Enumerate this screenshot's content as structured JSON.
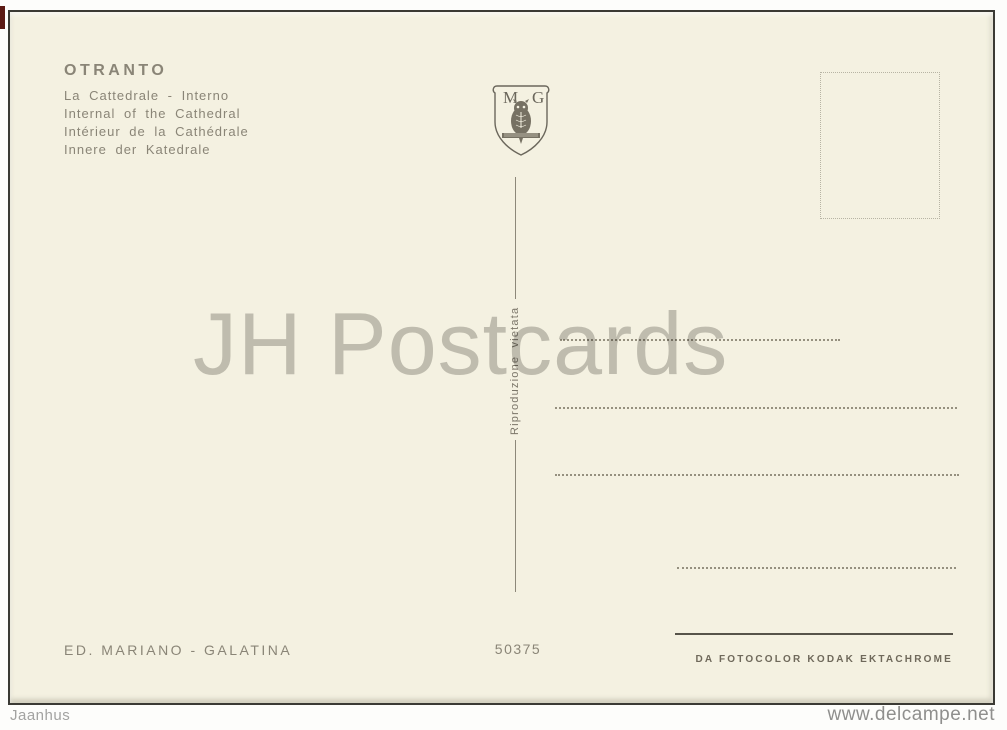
{
  "card": {
    "title": "OTRANTO",
    "captions": [
      "La Cattedrale - Interno",
      "Internal of the Cathedral",
      "Intérieur de la Cathédrale",
      "Innere der Katedrale"
    ],
    "emblem": {
      "left_letter": "M",
      "right_letter": "G",
      "icon": "owl-shield-emblem"
    },
    "reproduction_notice": "Riproduzione  vietata",
    "serial_number": "50375",
    "publisher_line": "ED. MARIANO - GALATINA",
    "film_credit": "DA FOTOCOLOR KODAK EKTACHROME"
  },
  "watermark_text": "JH Postcards",
  "footer": {
    "left": "Jaanhus",
    "right": "www.delcampe.net"
  },
  "colors": {
    "card_background": "#f4f1e1",
    "ink": "#8a8577",
    "small_print": "#6f695b",
    "watermark": "#b9b8b2",
    "artifact_red": "#5c1a14"
  }
}
